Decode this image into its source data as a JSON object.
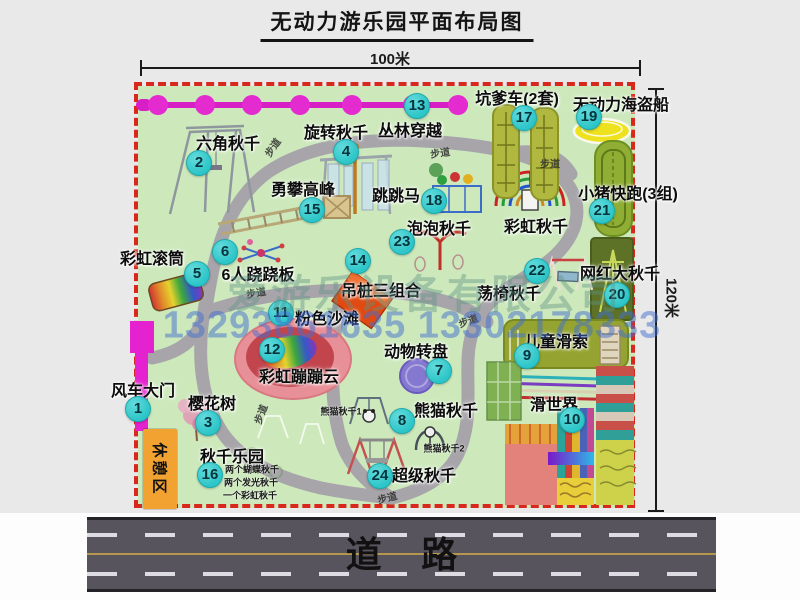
{
  "title": "无动力游乐园平面布局图",
  "dimensions": {
    "width": "100米",
    "height": "120米"
  },
  "road": {
    "label": "道路"
  },
  "watermark": {
    "company": "爱游乐设备有限公司",
    "phones": "13293861635 13302178333"
  },
  "rest_area": {
    "label": "休憩区"
  },
  "colors": {
    "map_bg": "#cde9bc",
    "border": "#d8281e",
    "badge": "#2cc5c8",
    "chain": "#d81fc6",
    "road_bg": "#58545e",
    "rest_bg": "#f2a231",
    "gate": "#e522cf"
  },
  "path_signs": [
    {
      "text": "步道",
      "x": 272,
      "y": 147,
      "rot": -55
    },
    {
      "text": "步道",
      "x": 440,
      "y": 152,
      "rot": -8
    },
    {
      "text": "步道",
      "x": 550,
      "y": 163,
      "rot": 0
    },
    {
      "text": "步道",
      "x": 256,
      "y": 292,
      "rot": -10
    },
    {
      "text": "步道",
      "x": 468,
      "y": 320,
      "rot": -20
    },
    {
      "text": "步道",
      "x": 260,
      "y": 414,
      "rot": -70
    },
    {
      "text": "步道",
      "x": 387,
      "y": 497,
      "rot": -15
    }
  ],
  "attractions": [
    {
      "num": "1",
      "name": "风车大门",
      "badge": {
        "x": 138,
        "y": 409
      },
      "label": {
        "x": 143,
        "y": 389
      }
    },
    {
      "num": "2",
      "name": "六角秋千",
      "badge": {
        "x": 199,
        "y": 163
      },
      "label": {
        "x": 228,
        "y": 142
      }
    },
    {
      "num": "3",
      "name": "樱花树",
      "badge": {
        "x": 208,
        "y": 423
      },
      "label": {
        "x": 212,
        "y": 402
      }
    },
    {
      "num": "4",
      "name": "旋转秋千",
      "badge": {
        "x": 346,
        "y": 152
      },
      "label": {
        "x": 336,
        "y": 131
      }
    },
    {
      "num": "5",
      "name": "彩虹滚筒",
      "badge": {
        "x": 197,
        "y": 274
      },
      "label": {
        "x": 152,
        "y": 257
      }
    },
    {
      "num": "6",
      "name": "6人跷跷板",
      "badge": {
        "x": 225,
        "y": 252
      },
      "label": {
        "x": 258,
        "y": 273
      }
    },
    {
      "num": "7",
      "name": "动物转盘",
      "badge": {
        "x": 439,
        "y": 371
      },
      "label": {
        "x": 416,
        "y": 350
      }
    },
    {
      "num": "8",
      "name": "熊猫秋千",
      "badge": {
        "x": 402,
        "y": 421
      },
      "label": {
        "x": 446,
        "y": 409
      },
      "notes": [
        {
          "text": "熊猫秋千1",
          "x": 341,
          "y": 411
        },
        {
          "text": "熊猫秋千2",
          "x": 444,
          "y": 448
        }
      ]
    },
    {
      "num": "9",
      "name": "儿童滑索",
      "badge": {
        "x": 527,
        "y": 356
      },
      "label": {
        "x": 556,
        "y": 340
      }
    },
    {
      "num": "10",
      "name": "滑世界",
      "badge": {
        "x": 572,
        "y": 420
      },
      "label": {
        "x": 554,
        "y": 403
      }
    },
    {
      "num": "11",
      "name": "粉色沙滩",
      "badge": {
        "x": 281,
        "y": 313
      },
      "label": {
        "x": 327,
        "y": 317
      }
    },
    {
      "num": "12",
      "name": "彩虹蹦蹦云",
      "badge": {
        "x": 272,
        "y": 350
      },
      "label": {
        "x": 299,
        "y": 375
      }
    },
    {
      "num": "13",
      "name": "丛林穿越",
      "badge": {
        "x": 417,
        "y": 106
      },
      "label": {
        "x": 410,
        "y": 129
      }
    },
    {
      "num": "14",
      "name": "吊桩三组合",
      "badge": {
        "x": 358,
        "y": 261
      },
      "label": {
        "x": 381,
        "y": 289
      }
    },
    {
      "num": "15",
      "name": "勇攀高峰",
      "badge": {
        "x": 312,
        "y": 210
      },
      "label": {
        "x": 303,
        "y": 188
      }
    },
    {
      "num": "16",
      "name": "秋千乐园",
      "badge": {
        "x": 210,
        "y": 475
      },
      "label": {
        "x": 232,
        "y": 455
      },
      "notes": [
        {
          "text": "两个蝴蝶秋千",
          "x": 252,
          "y": 469
        },
        {
          "text": "两个发光秋千",
          "x": 251,
          "y": 482
        },
        {
          "text": "一个彩虹秋千",
          "x": 250,
          "y": 495
        }
      ]
    },
    {
      "num": "17",
      "name": "坑爹车(2套)",
      "badge": {
        "x": 524,
        "y": 118
      },
      "label": {
        "x": 517,
        "y": 97
      }
    },
    {
      "num": "18",
      "name": "跳跳马",
      "badge": {
        "x": 434,
        "y": 201
      },
      "label": {
        "x": 396,
        "y": 194
      }
    },
    {
      "num": "19",
      "name": "无动力海盗船",
      "badge": {
        "x": 589,
        "y": 117
      },
      "label": {
        "x": 621,
        "y": 103
      }
    },
    {
      "num": "20",
      "name": "网红大秋千",
      "badge": {
        "x": 617,
        "y": 295
      },
      "label": {
        "x": 620,
        "y": 272
      }
    },
    {
      "num": "21",
      "name": "小猪快跑(3组)",
      "badge": {
        "x": 602,
        "y": 211
      },
      "label": {
        "x": 628,
        "y": 192
      }
    },
    {
      "num": "22",
      "name": "荡椅秋千",
      "badge": {
        "x": 537,
        "y": 271
      },
      "label": {
        "x": 509,
        "y": 292
      }
    },
    {
      "num": "23",
      "name": "泡泡秋千",
      "badge": {
        "x": 402,
        "y": 242
      },
      "label": {
        "x": 439,
        "y": 227
      }
    },
    {
      "num": "24",
      "name": "超级秋千",
      "badge": {
        "x": 380,
        "y": 476
      },
      "label": {
        "x": 424,
        "y": 474
      }
    }
  ],
  "extra_labels": [
    {
      "text": "彩虹秋千",
      "x": 536,
      "y": 225
    }
  ]
}
